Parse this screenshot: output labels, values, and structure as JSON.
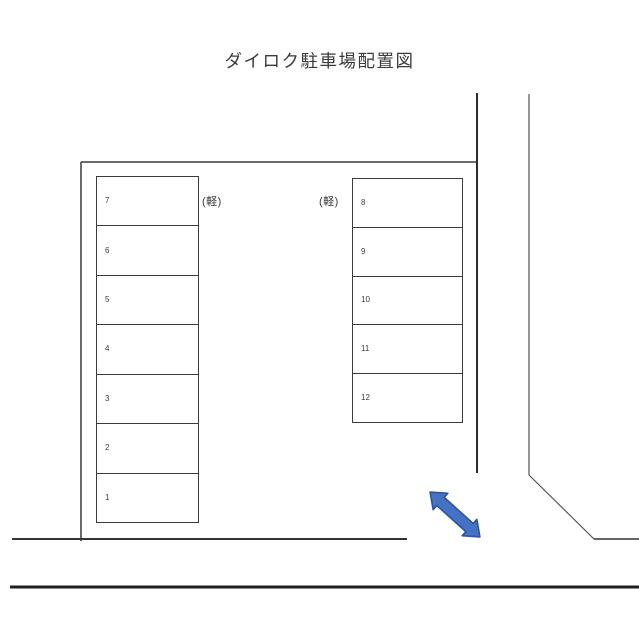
{
  "title": "ダイロク駐車場配置図",
  "lot": {
    "left_column": {
      "kei_label": "(軽)",
      "stalls": [
        {
          "number": "7"
        },
        {
          "number": "6"
        },
        {
          "number": "5"
        },
        {
          "number": "4"
        },
        {
          "number": "3"
        },
        {
          "number": "2"
        },
        {
          "number": "1"
        }
      ]
    },
    "right_column": {
      "kei_label": "(軽)",
      "stalls": [
        {
          "number": "8"
        },
        {
          "number": "9"
        },
        {
          "number": "10"
        },
        {
          "number": "11"
        },
        {
          "number": "12"
        }
      ]
    }
  },
  "colors": {
    "arrow_fill": "#4472C4",
    "arrow_stroke": "#2F5597",
    "boundary_line": "#3a3a3a",
    "road_line": "#1f1f1f"
  }
}
